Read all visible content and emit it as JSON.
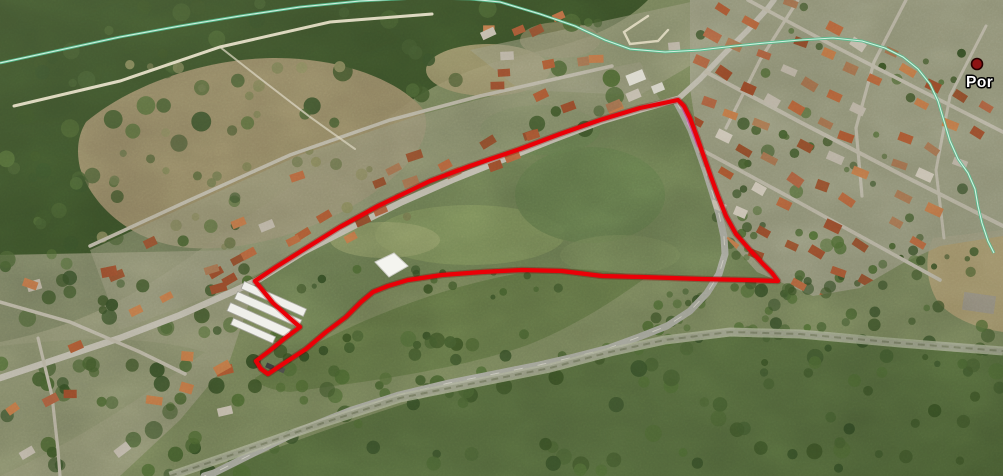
{
  "map": {
    "view_type": "satellite-aerial-oblique",
    "width": 1003,
    "height": 476
  },
  "overlay": {
    "parcel_outline": {
      "color": "#ea0007",
      "stroke_width": 4.2,
      "closed": true,
      "points": [
        [
          678,
          100
        ],
        [
          640,
          108
        ],
        [
          600,
          120
        ],
        [
          560,
          134
        ],
        [
          520,
          149
        ],
        [
          470,
          166
        ],
        [
          430,
          181
        ],
        [
          378,
          206
        ],
        [
          340,
          227
        ],
        [
          303,
          250
        ],
        [
          276,
          267
        ],
        [
          255,
          281
        ],
        [
          273,
          303
        ],
        [
          293,
          321
        ],
        [
          300,
          327
        ],
        [
          284,
          339
        ],
        [
          268,
          352
        ],
        [
          256,
          361
        ],
        [
          261,
          369
        ],
        [
          268,
          374
        ],
        [
          286,
          362
        ],
        [
          306,
          349
        ],
        [
          326,
          332
        ],
        [
          346,
          317
        ],
        [
          361,
          302
        ],
        [
          373,
          292
        ],
        [
          388,
          286
        ],
        [
          408,
          280
        ],
        [
          442,
          275
        ],
        [
          482,
          272
        ],
        [
          522,
          270
        ],
        [
          562,
          271
        ],
        [
          602,
          276
        ],
        [
          642,
          277
        ],
        [
          702,
          279
        ],
        [
          746,
          280
        ],
        [
          778,
          281
        ],
        [
          772,
          273
        ],
        [
          763,
          264
        ],
        [
          750,
          250
        ],
        [
          736,
          234
        ],
        [
          726,
          216
        ],
        [
          718,
          196
        ],
        [
          711,
          177
        ],
        [
          704,
          157
        ],
        [
          697,
          137
        ],
        [
          690,
          118
        ],
        [
          684,
          106
        ]
      ]
    },
    "area_boundary_line": {
      "color": "#55bd8e",
      "stroke_width": 2.7,
      "closed": false,
      "points": [
        [
          0,
          63
        ],
        [
          60,
          50
        ],
        [
          120,
          37
        ],
        [
          180,
          26
        ],
        [
          240,
          16
        ],
        [
          300,
          7
        ],
        [
          360,
          1
        ],
        [
          420,
          -2
        ],
        [
          470,
          -1
        ],
        [
          500,
          2
        ],
        [
          540,
          14
        ],
        [
          575,
          26
        ],
        [
          605,
          40
        ],
        [
          630,
          49
        ],
        [
          665,
          52
        ],
        [
          700,
          50
        ],
        [
          735,
          46
        ],
        [
          765,
          43
        ],
        [
          800,
          40
        ],
        [
          833,
          38
        ],
        [
          862,
          41
        ],
        [
          885,
          48
        ],
        [
          903,
          57
        ],
        [
          918,
          69
        ],
        [
          930,
          84
        ],
        [
          938,
          101
        ],
        [
          944,
          121
        ],
        [
          950,
          141
        ],
        [
          958,
          159
        ],
        [
          968,
          173
        ],
        [
          975,
          189
        ],
        [
          978,
          206
        ],
        [
          982,
          223
        ],
        [
          988,
          241
        ],
        [
          994,
          253
        ]
      ]
    },
    "secondary_line": {
      "color": "#e06cc8",
      "stroke_width": 2.4,
      "closed": false,
      "points": [
        [
          681,
          104
        ],
        [
          690,
          126
        ],
        [
          698,
          147
        ]
      ]
    },
    "placemark": {
      "label": "Por",
      "label_color": "#ffffff",
      "label_outline": "#000000",
      "label_pos": {
        "x": 966,
        "y": 87
      },
      "dot": {
        "x": 977,
        "y": 64,
        "radius": 5.5,
        "fill": "#8e1313",
        "stroke": "#260000"
      }
    }
  },
  "features": {
    "roads": [
      {
        "id": "main-road-west",
        "color": "#b6b2a3",
        "stroke_width": 6.5,
        "points": [
          [
            0,
            378
          ],
          [
            60,
            358
          ],
          [
            120,
            338
          ],
          [
            180,
            315
          ],
          [
            232,
            292
          ],
          [
            258,
            280
          ],
          [
            303,
            252
          ],
          [
            352,
            227
          ],
          [
            402,
            202
          ],
          [
            452,
            180
          ],
          [
            502,
            160
          ],
          [
            552,
            140
          ],
          [
            602,
            121
          ],
          [
            642,
            109
          ],
          [
            678,
            99
          ]
        ]
      },
      {
        "id": "road-north",
        "color": "#b3afa0",
        "stroke_width": 5.5,
        "points": [
          [
            678,
            99
          ],
          [
            700,
            79
          ],
          [
            724,
            54
          ],
          [
            748,
            30
          ],
          [
            768,
            8
          ],
          [
            774,
            0
          ]
        ]
      },
      {
        "id": "road-southeast-curve",
        "color": "#9b9c90",
        "stroke_width": 7,
        "points": [
          [
            676,
            101
          ],
          [
            683,
            114
          ],
          [
            691,
            130
          ],
          [
            698,
            149
          ],
          [
            705,
            169
          ],
          [
            712,
            191
          ],
          [
            719,
            214
          ],
          [
            724,
            237
          ],
          [
            725,
            254
          ],
          [
            719,
            274
          ],
          [
            707,
            293
          ],
          [
            690,
            311
          ],
          [
            667,
            326
          ],
          [
            639,
            337
          ],
          [
            609,
            348
          ],
          [
            574,
            357
          ],
          [
            539,
            365
          ],
          [
            499,
            373
          ],
          [
            449,
            383
          ],
          [
            399,
            395
          ],
          [
            349,
            411
          ],
          [
            299,
            431
          ],
          [
            254,
            453
          ],
          [
            214,
            473
          ],
          [
            204,
            476
          ]
        ]
      }
    ],
    "streets": [
      {
        "id": "upper-parallel-street",
        "stroke_width": 3.5,
        "points": [
          [
            90,
            246
          ],
          [
            190,
            200
          ],
          [
            290,
            155
          ],
          [
            390,
            120
          ],
          [
            480,
            96
          ],
          [
            555,
            79
          ],
          [
            612,
            66
          ]
        ]
      },
      {
        "id": "lower-left-street-a",
        "stroke_width": 3.5,
        "points": [
          [
            0,
            302
          ],
          [
            70,
            322
          ],
          [
            140,
            352
          ],
          [
            185,
            374
          ]
        ]
      },
      {
        "id": "lower-left-street-b",
        "stroke_width": 3.2,
        "points": [
          [
            38,
            338
          ],
          [
            52,
            396
          ],
          [
            58,
            450
          ],
          [
            60,
            476
          ]
        ]
      },
      {
        "id": "right-town-street-1",
        "stroke_width": 4,
        "points": [
          [
            706,
            72
          ],
          [
            800,
            122
          ],
          [
            900,
            174
          ],
          [
            1003,
            226
          ]
        ]
      },
      {
        "id": "right-town-street-2",
        "stroke_width": 3.6,
        "points": [
          [
            702,
            150
          ],
          [
            780,
            192
          ],
          [
            860,
            236
          ],
          [
            940,
            280
          ]
        ]
      },
      {
        "id": "right-town-street-3",
        "stroke_width": 3.6,
        "points": [
          [
            748,
            0
          ],
          [
            830,
            44
          ],
          [
            920,
            90
          ],
          [
            1003,
            132
          ]
        ]
      },
      {
        "id": "right-town-cross-1",
        "stroke_width": 3.2,
        "points": [
          [
            798,
            0
          ],
          [
            760,
            60
          ],
          [
            726,
            128
          ]
        ]
      },
      {
        "id": "right-town-cross-2",
        "stroke_width": 3.2,
        "points": [
          [
            906,
            0
          ],
          [
            874,
            62
          ],
          [
            856,
            128
          ],
          [
            862,
            196
          ]
        ]
      },
      {
        "id": "right-town-cross-3",
        "stroke_width": 3,
        "points": [
          [
            986,
            26
          ],
          [
            950,
            96
          ],
          [
            936,
            170
          ],
          [
            944,
            238
          ]
        ]
      }
    ],
    "railway": {
      "id": "railway-line",
      "points": [
        [
          170,
          476
        ],
        [
          240,
          452
        ],
        [
          320,
          424
        ],
        [
          400,
          398
        ],
        [
          480,
          382
        ],
        [
          550,
          368
        ],
        [
          610,
          352
        ],
        [
          665,
          340
        ],
        [
          730,
          332
        ],
        [
          800,
          334
        ],
        [
          900,
          343
        ],
        [
          1003,
          351
        ]
      ]
    },
    "dirt_paths": [
      {
        "id": "hillside-path",
        "stroke_width": 3,
        "points": [
          [
            14,
            106
          ],
          [
            120,
            81
          ],
          [
            220,
            47
          ],
          [
            330,
            22
          ],
          [
            432,
            14
          ]
        ]
      },
      {
        "id": "hillside-path-branch",
        "stroke_width": 2,
        "points": [
          [
            220,
            47
          ],
          [
            262,
            80
          ],
          [
            310,
            117
          ],
          [
            355,
            149
          ]
        ]
      },
      {
        "id": "junction-loop-path",
        "stroke_width": 2.4,
        "points": [
          [
            648,
            16
          ],
          [
            624,
            32
          ],
          [
            630,
            44
          ],
          [
            658,
            41
          ],
          [
            668,
            30
          ]
        ]
      }
    ],
    "warehouse": {
      "rotation": 24,
      "cx": 266,
      "cy": 314,
      "sheds": [
        {
          "x": 233,
          "y": 293,
          "w": 68,
          "h": 8
        },
        {
          "x": 231,
          "y": 305,
          "w": 70,
          "h": 8
        },
        {
          "x": 229,
          "y": 318,
          "w": 66,
          "h": 9
        },
        {
          "x": 238,
          "y": 331,
          "w": 46,
          "h": 7
        }
      ]
    },
    "tarp": {
      "points": [
        [
          375,
          262
        ],
        [
          394,
          253
        ],
        [
          408,
          266
        ],
        [
          389,
          277
        ]
      ],
      "closed": true
    }
  }
}
